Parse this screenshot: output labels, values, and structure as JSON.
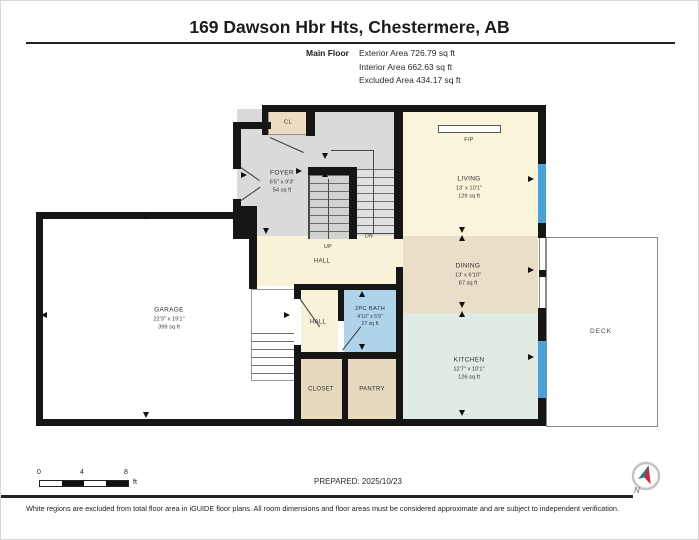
{
  "header": {
    "title": "169 Dawson Hbr Hts, Chestermere, AB",
    "floor_label": "Main Floor",
    "area_lines": [
      "Exterior Area 726.79 sq ft",
      "Interior Area 662.63 sq ft",
      "Excluded Area 434.17 sq ft"
    ]
  },
  "rooms": {
    "foyer": {
      "name": "FOYER",
      "dims": "6'5\" x 9'3\"",
      "area": "54 sq ft"
    },
    "entry_closet": {
      "name": "CL"
    },
    "living": {
      "name": "LIVING",
      "dims": "13' x 10'1\"",
      "area": "129 sq ft"
    },
    "dining": {
      "name": "DINING",
      "dims": "13' x 6'10\"",
      "area": "87 sq ft"
    },
    "kitchen": {
      "name": "KITCHEN",
      "dims": "12'7\" x 10'1\"",
      "area": "126 sq ft"
    },
    "garage": {
      "name": "GARAGE",
      "dims": "22'3\" x 19'1\"",
      "area": "399 sq ft"
    },
    "bath": {
      "name": "2PC BATH",
      "dims": "4'10\" x 5'9\"",
      "area": "27 sq ft"
    },
    "hall_upper": {
      "name": "HALL"
    },
    "hall_lower": {
      "name": "HALL"
    },
    "closet": {
      "name": "CLOSET"
    },
    "pantry": {
      "name": "PANTRY"
    },
    "deck": {
      "name": "DECK"
    },
    "fireplace": {
      "name": "F/P"
    }
  },
  "stairs": {
    "up": "UP",
    "down": "DN"
  },
  "scale_bar": {
    "ticks": [
      "0",
      "4",
      "8"
    ],
    "unit": "ft"
  },
  "footer": {
    "prepared": "PREPARED: 2025/10/23",
    "disclaimer": "White regions are excluded from total floor area in iGUIDE floor plans. All room dimensions and floor areas must be considered approximate and are subject to independent verification.",
    "compass_north": "N"
  },
  "colors": {
    "wall": "#161616",
    "window": "#4aa2d8",
    "gray_floor": "#dadada",
    "cream_floor": "#f8f3d8",
    "living_floor": "#f9f4da",
    "dining_floor": "#e9dfc9",
    "kitchen_floor": "#e0ebe4",
    "bath_floor": "#aed3ea",
    "tan_floor": "#e7d8c0",
    "cl_floor": "#eddcc2"
  }
}
